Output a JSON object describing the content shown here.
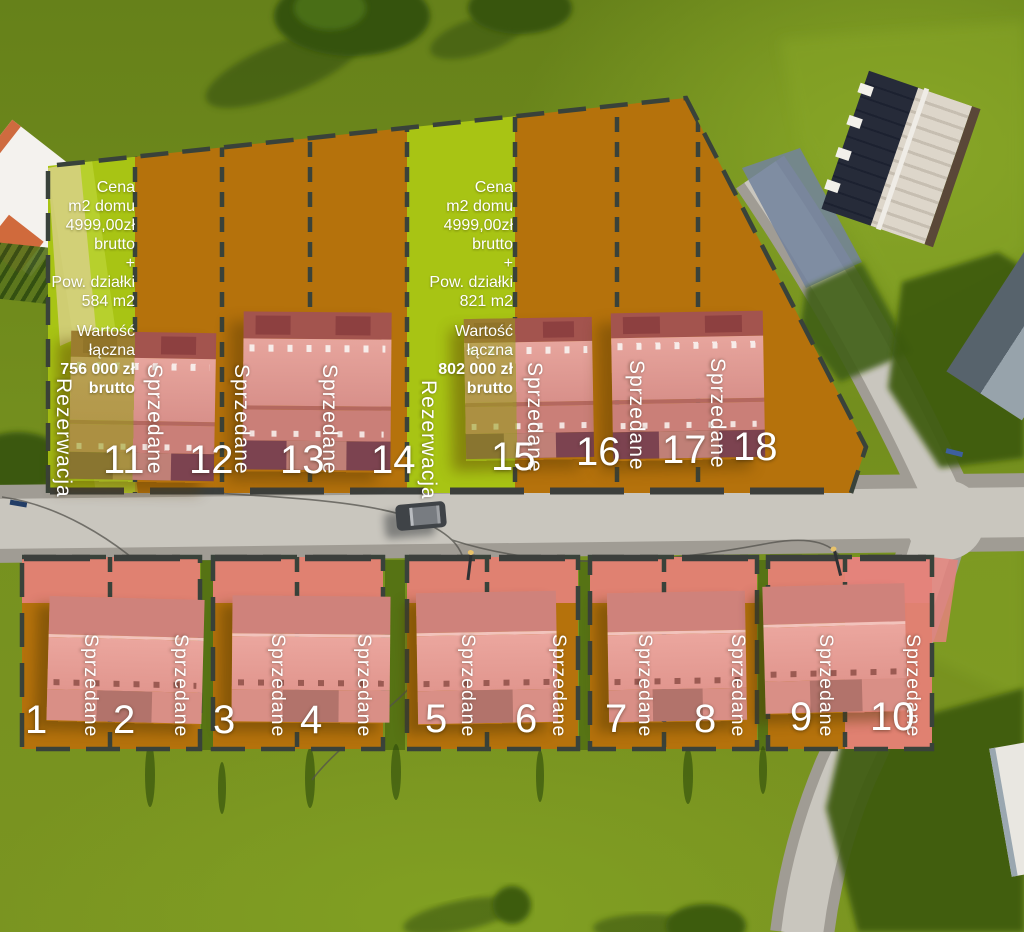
{
  "legend": {
    "sold_label": "Sprzedane",
    "reserved_label": "Rezerwacja"
  },
  "colors": {
    "reserved_zone": "#a8c414",
    "sold_land_zone": "#b5720c",
    "sold_house_zone": "#e4837c",
    "plot_border": "#39423a",
    "label_text": "#ffffff"
  },
  "top_row": {
    "plots": [
      {
        "number": "11",
        "status": "Rezerwacja"
      },
      {
        "number": "12",
        "status": "Sprzedane"
      },
      {
        "number": "13",
        "status": "Sprzedane"
      },
      {
        "number": "14",
        "status": "Sprzedane"
      },
      {
        "number": "15",
        "status": "Rezerwacja"
      },
      {
        "number": "16",
        "status": "Sprzedane"
      },
      {
        "number": "17",
        "status": "Sprzedane"
      },
      {
        "number": "18",
        "status": "Sprzedane"
      }
    ]
  },
  "bottom_row": {
    "plots": [
      {
        "number": "1",
        "status": "Sprzedane"
      },
      {
        "number": "2",
        "status": "Sprzedane"
      },
      {
        "number": "3",
        "status": "Sprzedane"
      },
      {
        "number": "4",
        "status": "Sprzedane"
      },
      {
        "number": "5",
        "status": "Sprzedane"
      },
      {
        "number": "6",
        "status": "Sprzedane"
      },
      {
        "number": "7",
        "status": "Sprzedane"
      },
      {
        "number": "8",
        "status": "Sprzedane"
      },
      {
        "number": "9",
        "status": "Sprzedane"
      },
      {
        "number": "10",
        "status": "Sprzedane"
      }
    ]
  },
  "offers": [
    {
      "plot": "11",
      "lines": "Cena\nm2 domu\n4999,00zł\nbrutto\n+\nPow. działki\n584 m2",
      "value_label": "Wartość\nłączna",
      "value": "756 000 zł\nbrutto"
    },
    {
      "plot": "15",
      "lines": "Cena\nm2 domu\n4999,00zł\nbrutto\n+\nPow. działki\n821 m2",
      "value_label": "Wartość\nłączna",
      "value": "802 000 zł\nbrutto"
    }
  ]
}
